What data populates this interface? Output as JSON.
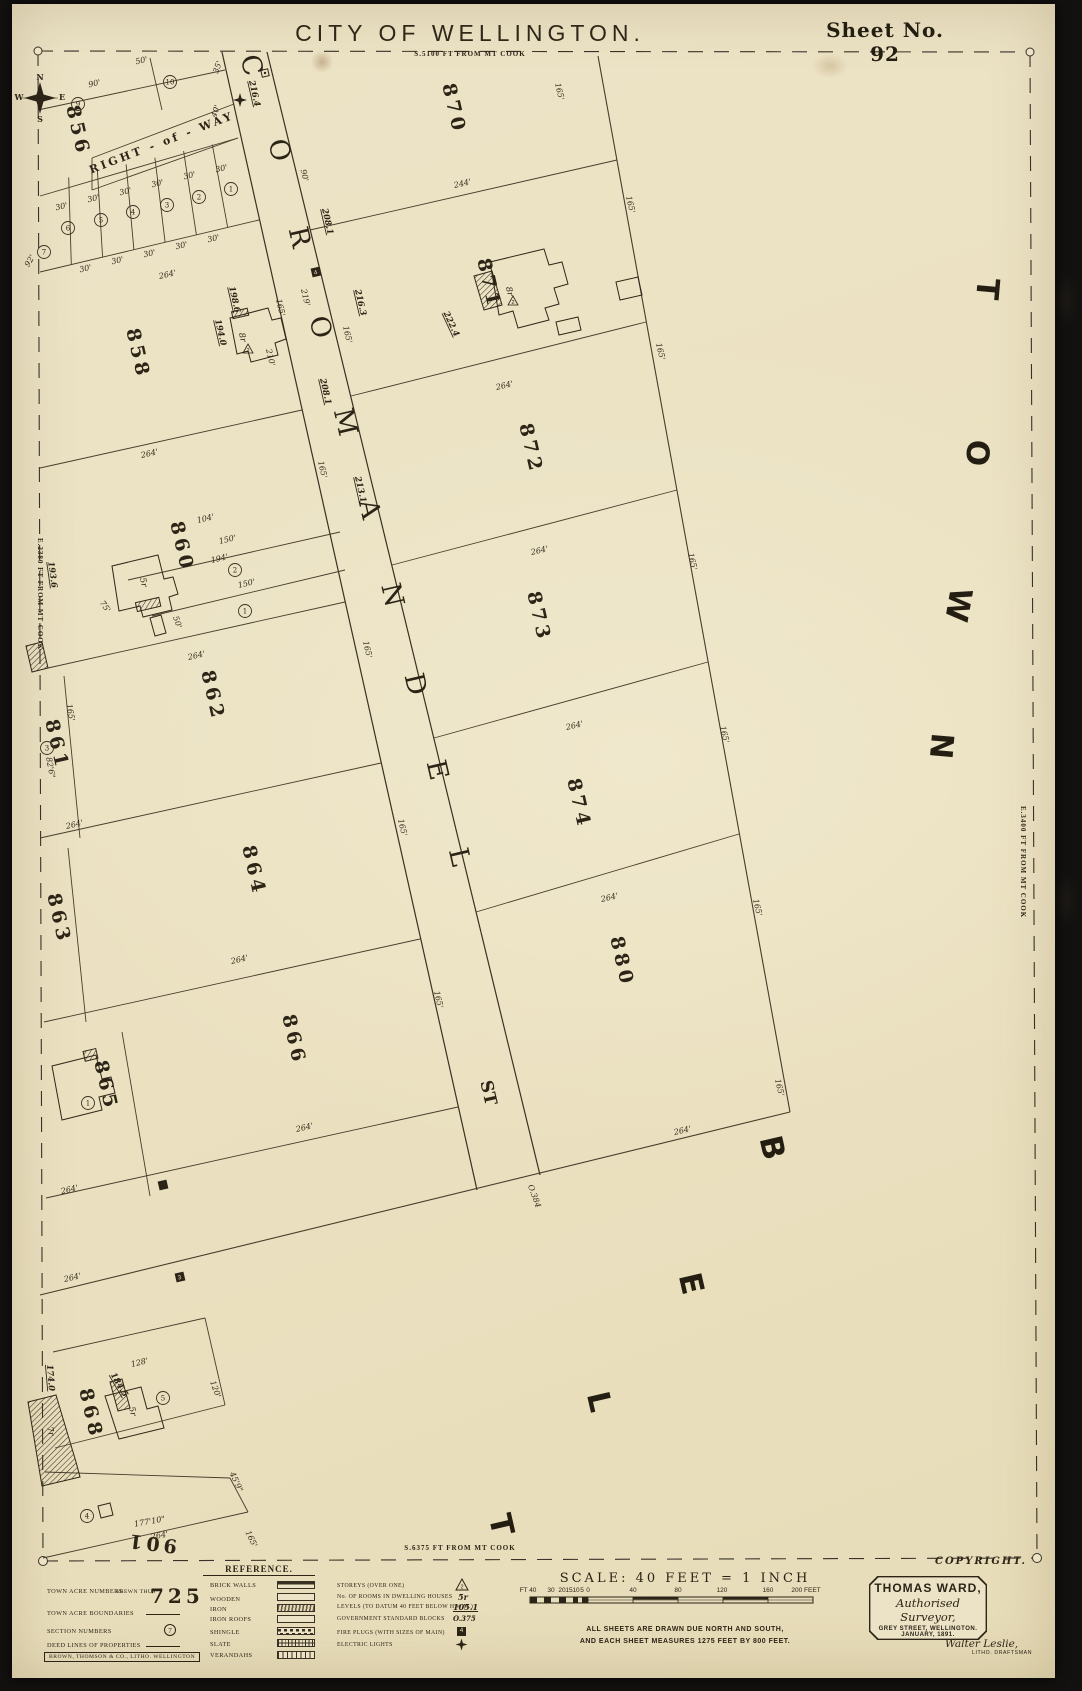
{
  "header": {
    "title": "CITY OF WELLINGTON.",
    "subtitle": "S.5100 FT FROM MT COOK",
    "sheet": "Sheet No. 92"
  },
  "edges": {
    "left": "E.2380 FT FROM MT COOK",
    "right": "E.3400 FT FROM MT COOK",
    "bottom": "S.6375 FT FROM MT COOK"
  },
  "map": {
    "street_name": "COROMANDEL ST",
    "district_name": "TOWN BELT",
    "right_of_way_label": "RIGHT - of - WAY",
    "compass": {
      "n": "N",
      "e": "E",
      "s": "S",
      "w": "W"
    },
    "acres": [
      {
        "n": "856",
        "x": 72,
        "y": 132
      },
      {
        "n": "858",
        "x": 132,
        "y": 355
      },
      {
        "n": "860",
        "x": 176,
        "y": 548
      },
      {
        "n": "861",
        "x": 51,
        "y": 746
      },
      {
        "n": "862",
        "x": 207,
        "y": 697
      },
      {
        "n": "863",
        "x": 53,
        "y": 920
      },
      {
        "n": "864",
        "x": 248,
        "y": 872
      },
      {
        "n": "865",
        "x": 100,
        "y": 1087
      },
      {
        "n": "866",
        "x": 288,
        "y": 1041
      },
      {
        "n": "868",
        "x": 85,
        "y": 1415
      },
      {
        "n": "870",
        "x": 448,
        "y": 110
      },
      {
        "n": "871",
        "x": 483,
        "y": 285
      },
      {
        "n": "872",
        "x": 525,
        "y": 450
      },
      {
        "n": "873",
        "x": 533,
        "y": 618
      },
      {
        "n": "874",
        "x": 573,
        "y": 805
      },
      {
        "n": "880",
        "x": 616,
        "y": 963
      },
      {
        "n": "901",
        "x": 152,
        "y": 1537,
        "r": 187
      }
    ],
    "street_letters": [
      {
        "t": "C",
        "x": 243,
        "y": 68
      },
      {
        "t": "O",
        "x": 271,
        "y": 153
      },
      {
        "t": "R",
        "x": 291,
        "y": 240
      },
      {
        "t": "O",
        "x": 312,
        "y": 330
      },
      {
        "t": "M",
        "x": 337,
        "y": 425
      },
      {
        "t": "A",
        "x": 361,
        "y": 512
      },
      {
        "t": "N",
        "x": 384,
        "y": 598
      },
      {
        "t": "D",
        "x": 407,
        "y": 687
      },
      {
        "t": "E",
        "x": 429,
        "y": 773
      },
      {
        "t": "L",
        "x": 451,
        "y": 860
      },
      {
        "t": "ST",
        "x": 483,
        "y": 1094
      }
    ],
    "district_letters": [
      {
        "t": "T",
        "x": 977,
        "y": 288,
        "r": 95
      },
      {
        "t": "O",
        "x": 967,
        "y": 452,
        "r": 95
      },
      {
        "t": "W",
        "x": 948,
        "y": 603,
        "r": 100
      },
      {
        "t": "N",
        "x": 931,
        "y": 745,
        "r": 95
      },
      {
        "t": "B",
        "x": 762,
        "y": 1150,
        "r": 77
      },
      {
        "t": "E",
        "x": 681,
        "y": 1286,
        "r": 77
      },
      {
        "t": "L",
        "x": 589,
        "y": 1404,
        "r": 77
      },
      {
        "t": "T",
        "x": 491,
        "y": 1527,
        "r": 77
      }
    ],
    "labels": [
      {
        "t": "90'",
        "x": 95,
        "y": 86,
        "r": -13
      },
      {
        "t": "50'",
        "x": 142,
        "y": 63,
        "r": -13
      },
      {
        "t": "35'",
        "x": 220,
        "y": 68,
        "r": -70
      },
      {
        "t": "40'",
        "x": 218,
        "y": 112,
        "r": -70
      },
      {
        "t": "30'",
        "x": 222,
        "y": 171,
        "r": -13
      },
      {
        "t": "30'",
        "x": 190,
        "y": 178,
        "r": -13
      },
      {
        "t": "30'",
        "x": 158,
        "y": 186,
        "r": -13
      },
      {
        "t": "30'",
        "x": 126,
        "y": 194,
        "r": -13
      },
      {
        "t": "30'",
        "x": 94,
        "y": 201,
        "r": -13
      },
      {
        "t": "30'",
        "x": 62,
        "y": 209,
        "r": -13
      },
      {
        "t": "30'",
        "x": 214,
        "y": 241,
        "r": -13
      },
      {
        "t": "30'",
        "x": 182,
        "y": 248,
        "r": -13
      },
      {
        "t": "30'",
        "x": 150,
        "y": 256,
        "r": -13
      },
      {
        "t": "30'",
        "x": 118,
        "y": 263,
        "r": -13
      },
      {
        "t": "30'",
        "x": 86,
        "y": 271,
        "r": -13
      },
      {
        "t": "264'",
        "x": 168,
        "y": 277,
        "r": -13
      },
      {
        "t": "92'",
        "x": 32,
        "y": 262,
        "r": -60
      },
      {
        "t": "264'",
        "x": 150,
        "y": 456,
        "r": -13
      },
      {
        "t": "210'",
        "x": 268,
        "y": 358,
        "r": 77
      },
      {
        "t": "165'",
        "x": 278,
        "y": 308,
        "r": 77
      },
      {
        "t": "198.6",
        "x": 232,
        "y": 300,
        "r": 77,
        "c": "lvl"
      },
      {
        "t": "194.0",
        "x": 218,
        "y": 333,
        "r": 77,
        "c": "lvl"
      },
      {
        "t": "90'",
        "x": 302,
        "y": 176,
        "r": 77
      },
      {
        "t": "264'",
        "x": 197,
        "y": 658,
        "r": -13
      },
      {
        "t": "194'",
        "x": 220,
        "y": 561,
        "r": -13
      },
      {
        "t": "150'",
        "x": 247,
        "y": 586,
        "r": -13
      },
      {
        "t": "104'",
        "x": 206,
        "y": 521,
        "r": -13
      },
      {
        "t": "150'",
        "x": 228,
        "y": 542,
        "r": -13
      },
      {
        "t": "75'",
        "x": 103,
        "y": 608,
        "r": 55
      },
      {
        "t": "50'",
        "x": 175,
        "y": 623,
        "r": 70
      },
      {
        "t": "193.6",
        "x": 50,
        "y": 575,
        "r": 82,
        "c": "lvl"
      },
      {
        "t": "264'",
        "x": 75,
        "y": 827,
        "r": -13
      },
      {
        "t": "165'",
        "x": 68,
        "y": 713,
        "r": 80
      },
      {
        "t": "82'6\"",
        "x": 48,
        "y": 768,
        "r": 80
      },
      {
        "t": "264'",
        "x": 240,
        "y": 962,
        "r": -13
      },
      {
        "t": "264'",
        "x": 305,
        "y": 1130,
        "r": -13
      },
      {
        "t": "264'",
        "x": 70,
        "y": 1192,
        "r": -13
      },
      {
        "t": "264'",
        "x": 73,
        "y": 1280,
        "r": -13
      },
      {
        "t": "128'",
        "x": 140,
        "y": 1365,
        "r": -13
      },
      {
        "t": "120'",
        "x": 213,
        "y": 1390,
        "r": 70
      },
      {
        "t": "174.0",
        "x": 48,
        "y": 1378,
        "r": 85,
        "c": "lvl"
      },
      {
        "t": "184.5",
        "x": 117,
        "y": 1386,
        "r": 60,
        "c": "lvl"
      },
      {
        "t": "177'10\"",
        "x": 150,
        "y": 1524,
        "r": -10
      },
      {
        "t": "264'",
        "x": 160,
        "y": 1538,
        "r": -10
      },
      {
        "t": "45'9\"",
        "x": 234,
        "y": 1483,
        "r": 65
      },
      {
        "t": "165'",
        "x": 249,
        "y": 1540,
        "r": 65
      },
      {
        "t": "244'",
        "x": 463,
        "y": 186,
        "r": -13
      },
      {
        "t": "165'",
        "x": 557,
        "y": 92,
        "r": 77
      },
      {
        "t": "165'",
        "x": 628,
        "y": 205,
        "r": 77
      },
      {
        "t": "264'",
        "x": 505,
        "y": 388,
        "r": -13
      },
      {
        "t": "222.4",
        "x": 449,
        "y": 325,
        "r": 65,
        "c": "lvl"
      },
      {
        "t": "165'",
        "x": 658,
        "y": 352,
        "r": 77
      },
      {
        "t": "264'",
        "x": 540,
        "y": 553,
        "r": -13
      },
      {
        "t": "165'",
        "x": 690,
        "y": 562,
        "r": 77
      },
      {
        "t": "264'",
        "x": 575,
        "y": 728,
        "r": -13
      },
      {
        "t": "165'",
        "x": 722,
        "y": 735,
        "r": 77
      },
      {
        "t": "264'",
        "x": 610,
        "y": 900,
        "r": -13
      },
      {
        "t": "165'",
        "x": 755,
        "y": 908,
        "r": 77
      },
      {
        "t": "264'",
        "x": 683,
        "y": 1133,
        "r": -13
      },
      {
        "t": "165'",
        "x": 777,
        "y": 1088,
        "r": 77
      },
      {
        "t": "O.384",
        "x": 532,
        "y": 1197,
        "r": 70
      },
      {
        "t": "216.4",
        "x": 252,
        "y": 94,
        "r": 77,
        "c": "lvl"
      },
      {
        "t": "208.1",
        "x": 325,
        "y": 222,
        "r": 77,
        "c": "lvl"
      },
      {
        "t": "219'",
        "x": 303,
        "y": 298,
        "r": 77
      },
      {
        "t": "216.3",
        "x": 358,
        "y": 303,
        "r": 77,
        "c": "lvl"
      },
      {
        "t": "208.1",
        "x": 323,
        "y": 392,
        "r": 77,
        "c": "lvl"
      },
      {
        "t": "213.1",
        "x": 358,
        "y": 490,
        "r": 77,
        "c": "lvl"
      },
      {
        "t": "165'",
        "x": 320,
        "y": 470,
        "r": 77
      },
      {
        "t": "165'",
        "x": 365,
        "y": 650,
        "r": 77
      },
      {
        "t": "165'",
        "x": 400,
        "y": 828,
        "r": 77
      },
      {
        "t": "165'",
        "x": 436,
        "y": 1000,
        "r": 77
      },
      {
        "t": "165'",
        "x": 345,
        "y": 335,
        "r": 77
      },
      {
        "t": "8r",
        "x": 507,
        "y": 292,
        "r": 77,
        "c": "house"
      },
      {
        "t": "8r",
        "x": 240,
        "y": 338,
        "r": 77,
        "c": "house"
      },
      {
        "t": "5r",
        "x": 141,
        "y": 583,
        "r": 77,
        "c": "house"
      },
      {
        "t": "5r",
        "x": 130,
        "y": 1412,
        "r": 77,
        "c": "house"
      },
      {
        "t": "7r",
        "x": 48,
        "y": 1432,
        "r": 77,
        "c": "house"
      }
    ],
    "section_circles": [
      {
        "n": "9",
        "x": 78,
        "y": 104
      },
      {
        "n": "10",
        "x": 170,
        "y": 82
      },
      {
        "n": "1",
        "x": 231,
        "y": 189
      },
      {
        "n": "2",
        "x": 199,
        "y": 197
      },
      {
        "n": "3",
        "x": 167,
        "y": 205
      },
      {
        "n": "4",
        "x": 133,
        "y": 212
      },
      {
        "n": "5",
        "x": 101,
        "y": 220
      },
      {
        "n": "6",
        "x": 68,
        "y": 228
      },
      {
        "n": "7",
        "x": 44,
        "y": 252
      },
      {
        "n": "2",
        "x": 235,
        "y": 570
      },
      {
        "n": "1",
        "x": 245,
        "y": 611
      },
      {
        "n": "3",
        "x": 47,
        "y": 748
      },
      {
        "n": "1",
        "x": 88,
        "y": 1103
      },
      {
        "n": "5",
        "x": 163,
        "y": 1398
      },
      {
        "n": "4",
        "x": 87,
        "y": 1516
      }
    ],
    "fire_plugs": [
      {
        "n": "4",
        "x": 316,
        "y": 272
      },
      {
        "n": "3",
        "x": 180,
        "y": 1277
      },
      {
        "n": "",
        "x": 163,
        "y": 1185
      }
    ],
    "blocks": [
      {
        "x": 265,
        "y": 73
      }
    ],
    "electric_lights": [
      {
        "x": 240,
        "y": 100
      }
    ],
    "storey_triangles": [
      {
        "n": "2",
        "x": 248,
        "y": 350
      },
      {
        "n": "2",
        "x": 513,
        "y": 302
      }
    ]
  },
  "legend": {
    "heading": "REFERENCE.",
    "left": [
      {
        "label": "TOWN ACRE NUMBERS",
        "note": "SHEWN THUS",
        "sample": "725"
      },
      {
        "label": "TOWN ACRE BOUNDARIES"
      },
      {
        "label": "SECTION NUMBERS",
        "symbol": "7"
      },
      {
        "label": "DEED LINES OF PROPERTIES"
      }
    ],
    "middle": [
      {
        "label": "BRICK WALLS"
      },
      {
        "label": "WOODEN"
      },
      {
        "label": "IRON"
      },
      {
        "label": "IRON ROOFS"
      },
      {
        "label": "SHINGLE"
      },
      {
        "label": "SLATE"
      },
      {
        "label": "VERANDAHS"
      }
    ],
    "right": [
      {
        "label": "STOREYS (OVER ONE)",
        "symbol": "2"
      },
      {
        "label": "No. OF ROOMS IN DWELLING HOUSES",
        "symbol": "5r"
      },
      {
        "label": "LEVELS (TO DATUM 40 FEET BELOW H.W.M.)",
        "symbol": "105.1"
      },
      {
        "label": "GOVERNMENT STANDARD BLOCKS",
        "symbol": "O.375"
      },
      {
        "label": "FIRE PLUGS (WITH SIZES OF MAIN)",
        "symbol": "4"
      },
      {
        "label": "ELECTRIC LIGHTS"
      }
    ],
    "lithographer": "BROWN, THOMSON & CO., LITHO. WELLINGTON"
  },
  "scale": {
    "heading": "SCALE: 40 FEET = 1 INCH",
    "ticks": [
      {
        "t": "FT 40",
        "x": 528
      },
      {
        "t": "30",
        "x": 551
      },
      {
        "t": "20",
        "x": 562
      },
      {
        "t": "15",
        "x": 569
      },
      {
        "t": "10",
        "x": 576
      },
      {
        "t": "5",
        "x": 582
      },
      {
        "t": "0",
        "x": 588
      },
      {
        "t": "40",
        "x": 633
      },
      {
        "t": "80",
        "x": 678
      },
      {
        "t": "120",
        "x": 722
      },
      {
        "t": "160",
        "x": 768
      },
      {
        "t": "200 FEET",
        "x": 806
      }
    ],
    "note1": "ALL SHEETS ARE DRAWN DUE NORTH AND SOUTH,",
    "note2": "AND EACH SHEET MEASURES 1275 FEET BY 800 FEET."
  },
  "surveyor": {
    "name": "THOMAS WARD,",
    "title": "Authorised Surveyor,",
    "address": "GREY STREET, WELLINGTON.",
    "date": "JANUARY, 1891."
  },
  "credits": {
    "copyright": "COPYRIGHT.",
    "draftsman_name": "Walter Leslie,",
    "draftsman_role": "LITHO. DRAFTSMAN"
  }
}
